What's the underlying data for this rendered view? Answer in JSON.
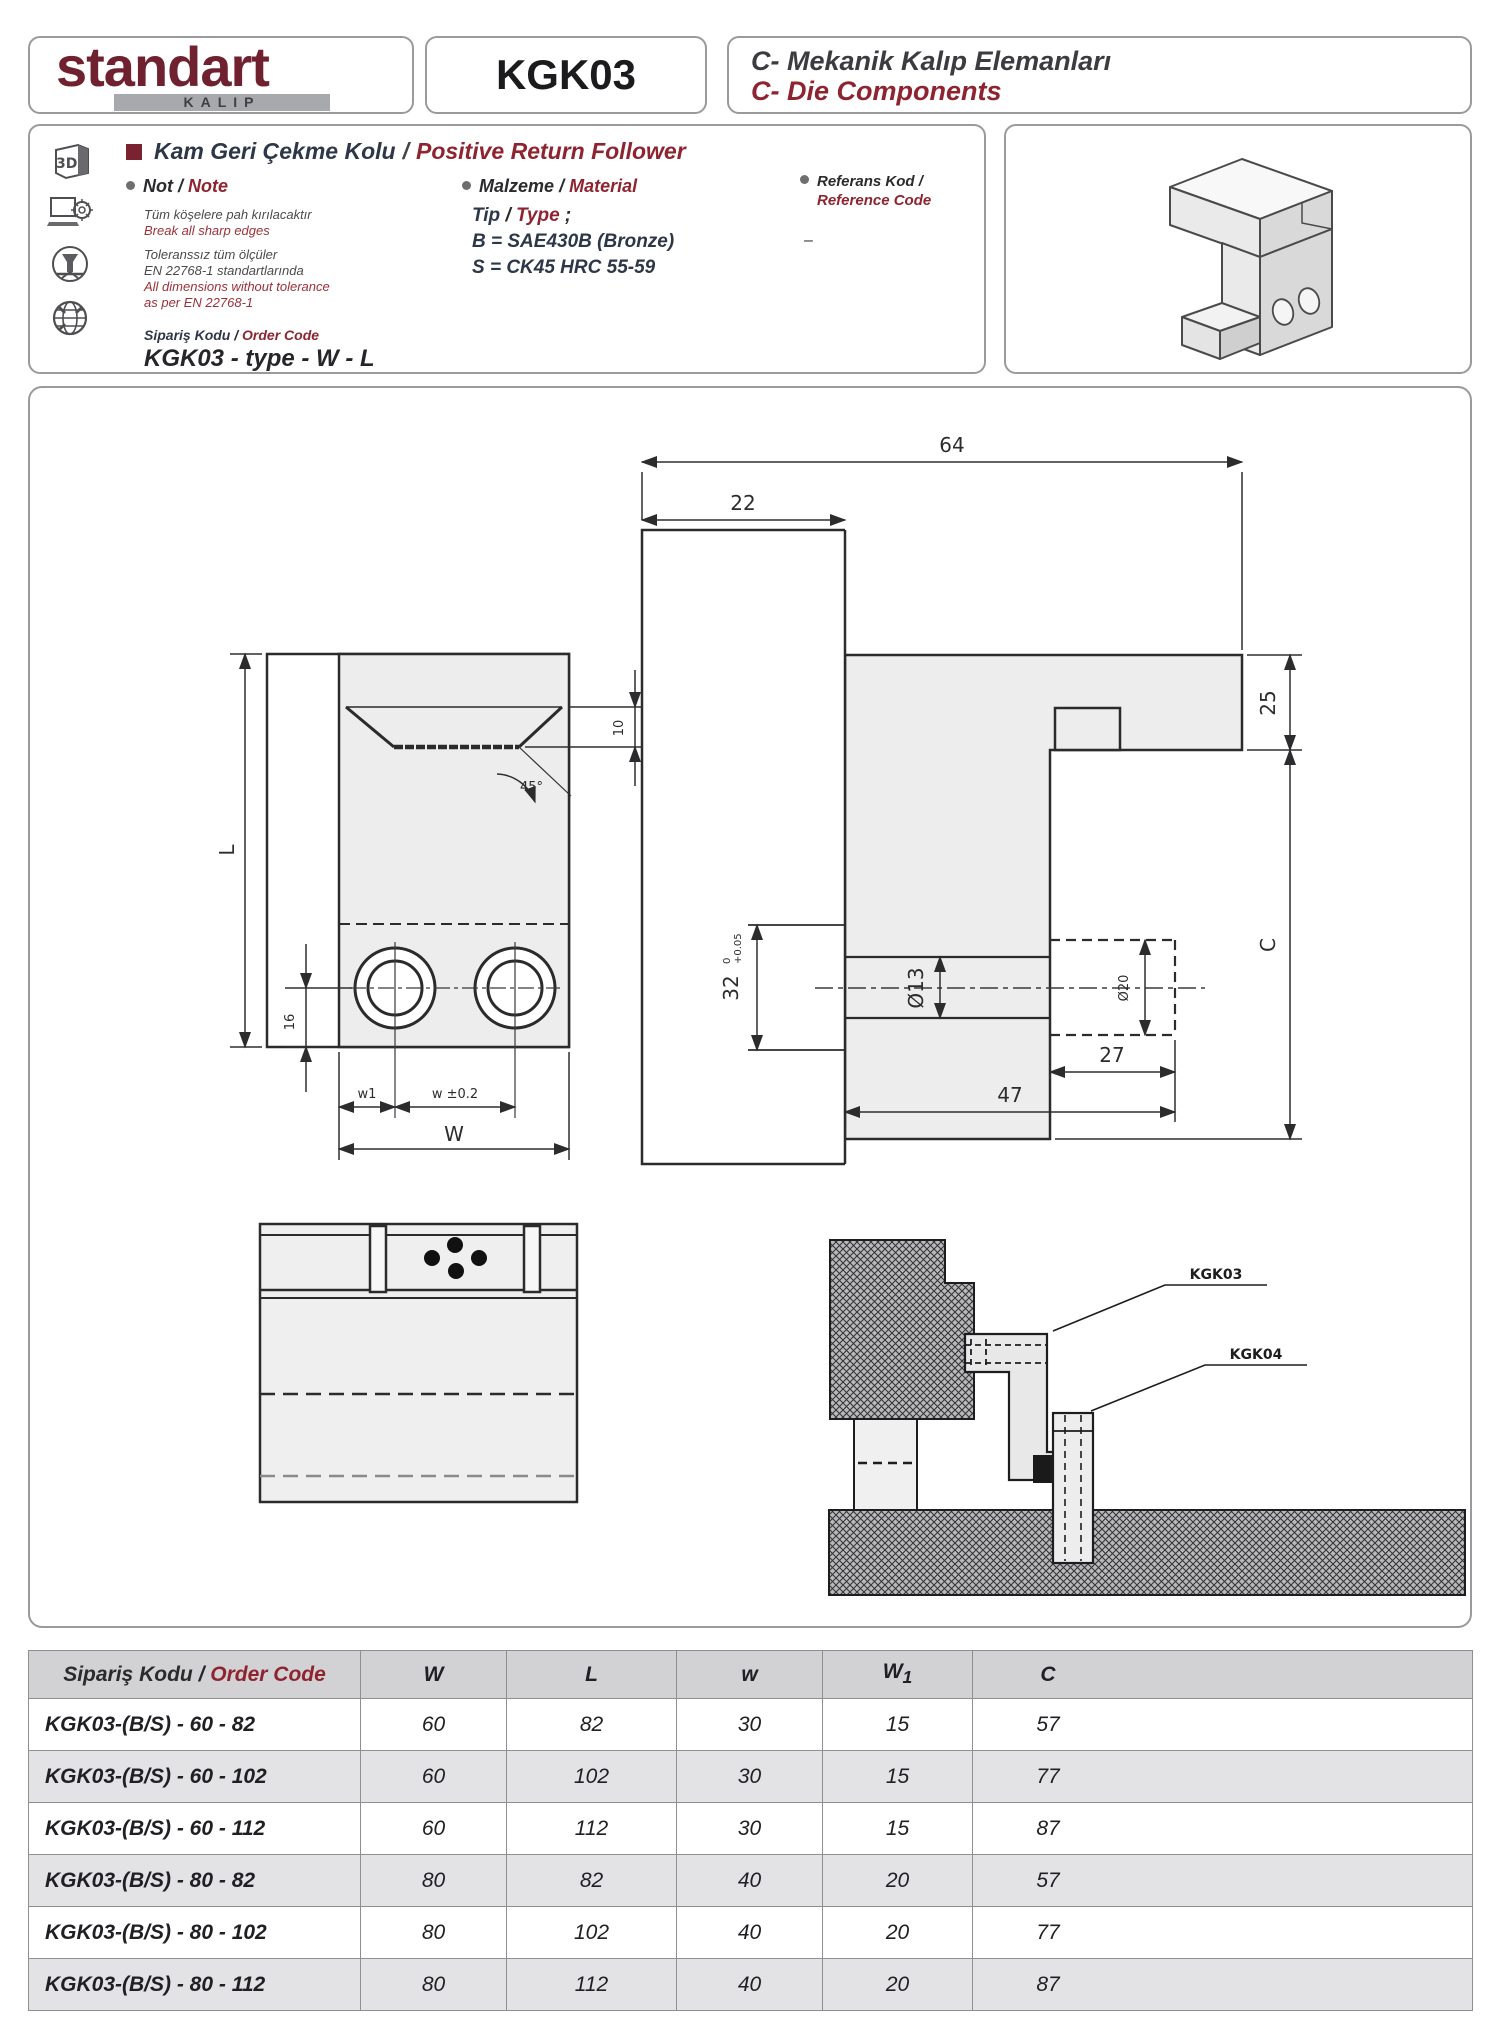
{
  "sep": "/",
  "header": {
    "logo_main": "standart",
    "logo_sub": "KALIP",
    "product_code": "KGK03",
    "category_tr": "C- Mekanik Kalıp Elemanları",
    "category_en": "C- Die Components"
  },
  "info": {
    "title_tr": "Kam Geri Çekme Kolu",
    "title_en": "Positive Return Follower",
    "icons": {
      "threed": "3D"
    },
    "note": {
      "label_tr": "Not",
      "label_en": "Note",
      "tr1": "Tüm köşelere  pah kırılacaktır",
      "en1": "Break all sharp edges",
      "tr2a": "Toleranssız tüm ölçüler",
      "tr2b": "EN 22768-1 standartlarında",
      "en2a": "All dimensions without tolerance",
      "en2b": "as per EN 22768-1"
    },
    "material": {
      "label_tr": "Malzeme",
      "label_en": "Material",
      "type_tr": "Tip",
      "type_en": "Type",
      "type_suffix": " ;",
      "line_b": "B = SAE430B (Bronze)",
      "line_s": "S = CK45  HRC 55-59"
    },
    "reference": {
      "label_tr": "Referans Kod /",
      "label_en": "Reference Code",
      "value": "–"
    },
    "order": {
      "label_tr": "Sipariş Kodu",
      "label_en": "Order Code",
      "value": "KGK03 - type - W - L"
    }
  },
  "drawings": {
    "front": {
      "dim_L": "L",
      "dim_10": "10",
      "dim_45": "45°",
      "dim_16": "16",
      "dim_w1": "w1",
      "dim_w": "w ±0.2",
      "dim_W": "W"
    },
    "side": {
      "dim_64": "64",
      "dim_22": "22",
      "dim_25": "25",
      "dim_C": "C",
      "dim_32": "32",
      "dim_32_tol_top": "0",
      "dim_32_tol_bot": "+0.05",
      "dim_13": "Ø13",
      "dim_20": "Ø20",
      "dim_27": "27",
      "dim_47": "47"
    },
    "assembly": {
      "label_1": "KGK03",
      "label_2": "KGK04"
    }
  },
  "table": {
    "headers": {
      "code_tr": "Sipariş Kodu",
      "code_en": "Order Code",
      "w": "W",
      "l": "L",
      "w_small": "w",
      "w1_base": "W",
      "w1_sub": "1",
      "c": "C"
    },
    "rows": [
      {
        "code": "KGK03-(B/S) - 60 - 82",
        "W": "60",
        "L": "82",
        "w": "30",
        "W1": "15",
        "C": "57"
      },
      {
        "code": "KGK03-(B/S) - 60 - 102",
        "W": "60",
        "L": "102",
        "w": "30",
        "W1": "15",
        "C": "77"
      },
      {
        "code": "KGK03-(B/S) - 60 - 112",
        "W": "60",
        "L": "112",
        "w": "30",
        "W1": "15",
        "C": "87"
      },
      {
        "code": "KGK03-(B/S) - 80 - 82",
        "W": "80",
        "L": "82",
        "w": "40",
        "W1": "20",
        "C": "57"
      },
      {
        "code": "KGK03-(B/S) - 80 - 102",
        "W": "80",
        "L": "102",
        "w": "40",
        "W1": "20",
        "C": "77"
      },
      {
        "code": "KGK03-(B/S) - 80 - 112",
        "W": "80",
        "L": "112",
        "w": "40",
        "W1": "20",
        "C": "87"
      }
    ]
  }
}
